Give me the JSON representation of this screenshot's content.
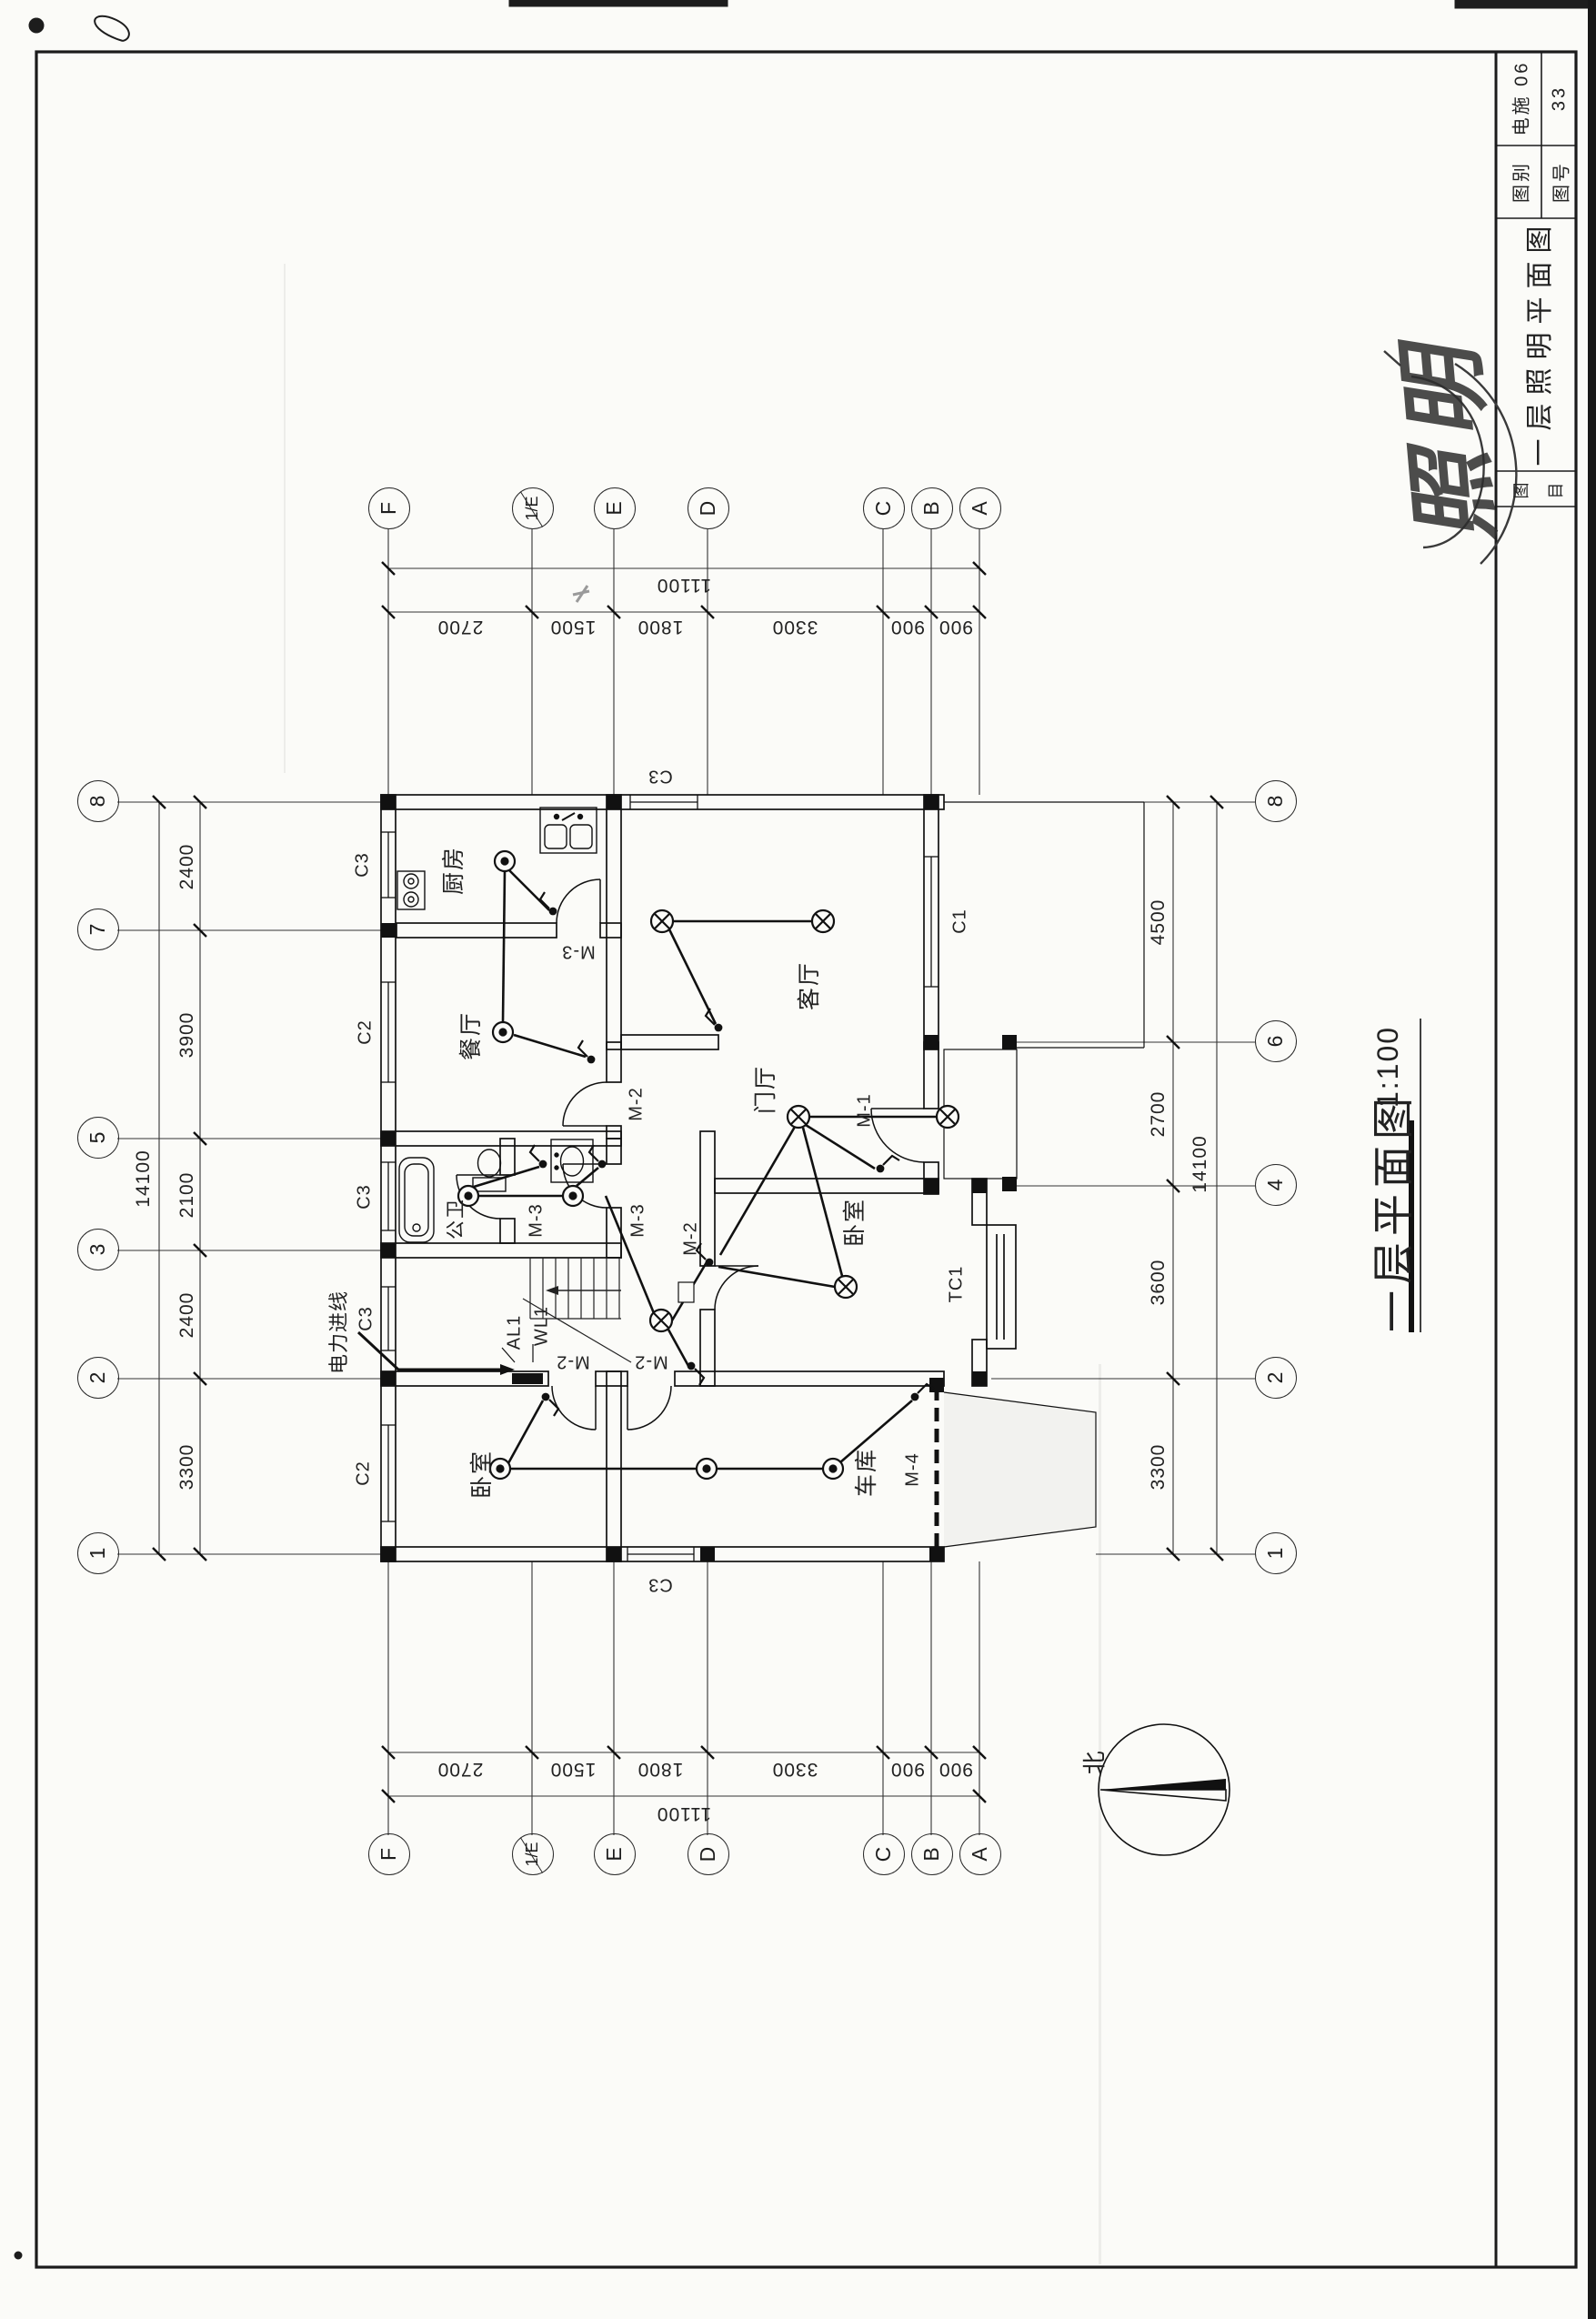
{
  "title_block": {
    "category_label": "图别",
    "category_value": "电施 06",
    "number_label": "图号",
    "number_value": "33",
    "name_label_top": "图",
    "name_label_bottom": "目",
    "drawing_title": "一层照明平面图"
  },
  "stamp": {
    "text": "照明"
  },
  "plan": {
    "title": "一层平面图",
    "scale": "1:100",
    "north_label": "北",
    "rooms": {
      "kitchen": "厨房",
      "dining": "餐厅",
      "living": "客厅",
      "foyer": "门厅",
      "bedroom_main": "卧室",
      "bedroom_left": "卧室",
      "garage": "车库",
      "bath": "公卫"
    },
    "doors": {
      "m1": "M-1",
      "m2": "M-2",
      "m3": "M-3",
      "m4": "M-4"
    },
    "windows": {
      "c1": "C1",
      "c2": "C2",
      "c3": "C3",
      "tc1": "TC1"
    },
    "electrical": {
      "feed": "电力进线",
      "panel": "AL1",
      "circuit": "WL1"
    }
  },
  "grid": {
    "cols_top": [
      "1",
      "2",
      "3",
      "5",
      "7",
      "8"
    ],
    "cols_bottom": [
      "1",
      "2",
      "4",
      "6",
      "8"
    ],
    "rows": [
      "F",
      "1/E",
      "E",
      "D",
      "C",
      "B",
      "A"
    ]
  },
  "dims": {
    "top_chain": [
      "3300",
      "2400",
      "2100",
      "3900",
      "2400"
    ],
    "bottom_chain": [
      "3300",
      "3600",
      "2700",
      "4500"
    ],
    "row_chain": [
      "2700",
      "1500",
      "1800",
      "3300",
      "900",
      "900"
    ],
    "total_width": "14100",
    "total_height": "11100"
  }
}
